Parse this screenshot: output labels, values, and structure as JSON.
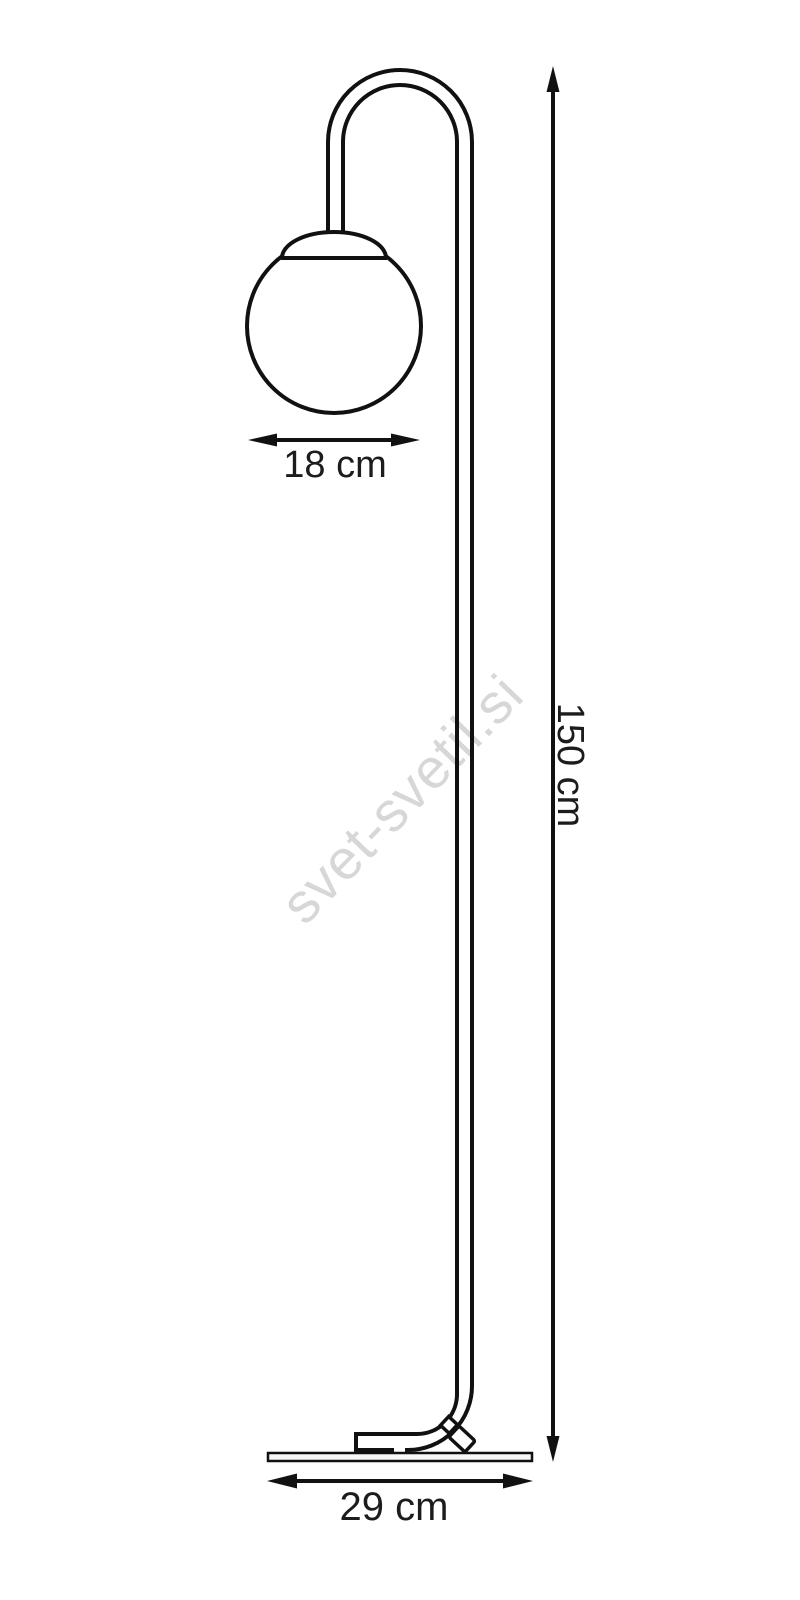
{
  "diagram": {
    "subject": "floor lamp outline drawing",
    "watermark": {
      "text": "svet-svetil.si",
      "color": "#d7d7d7"
    },
    "style": {
      "background": "#ffffff",
      "line_color": "#111111",
      "label_color": "#1c1c1c"
    },
    "dimensions": {
      "globe_diameter": {
        "label": "18 cm",
        "orientation": "horizontal"
      },
      "lamp_height": {
        "label": "150 cm",
        "orientation": "vertical"
      },
      "base_width": {
        "label": "29 cm",
        "orientation": "horizontal"
      }
    }
  }
}
